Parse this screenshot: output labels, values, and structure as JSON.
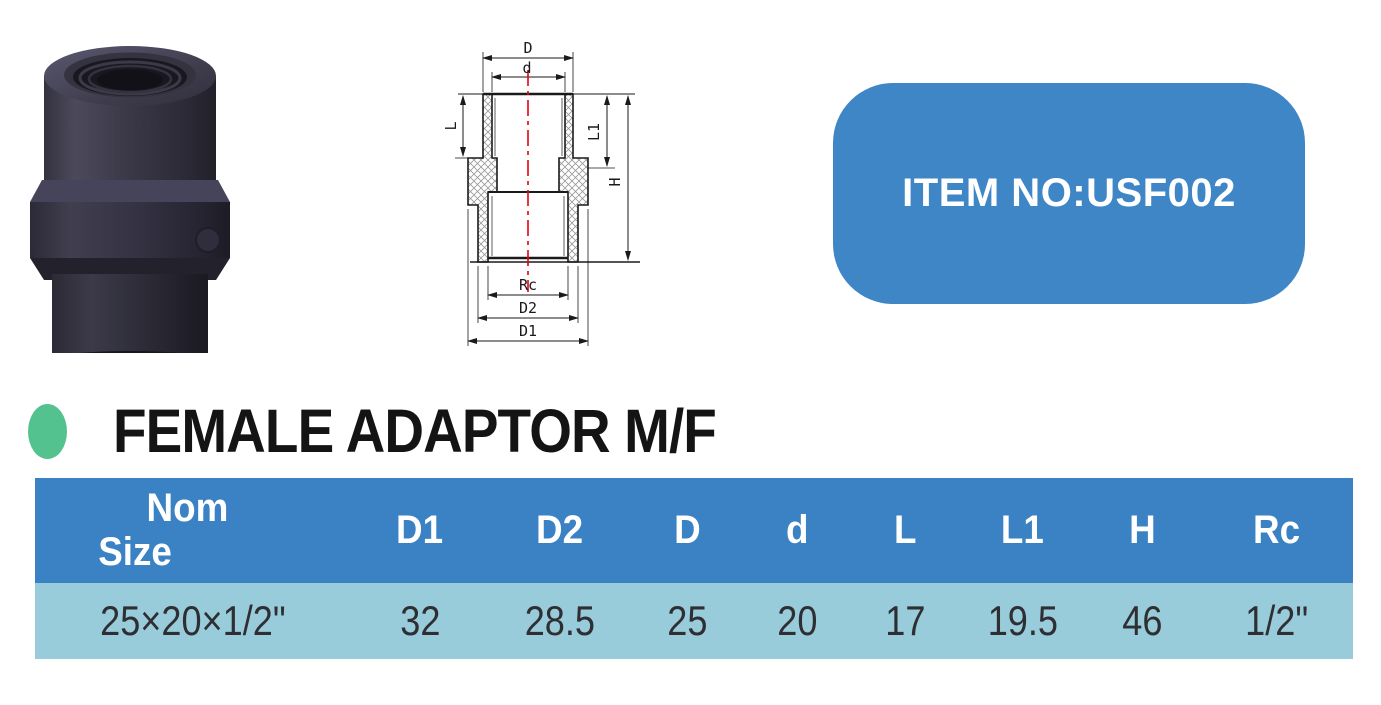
{
  "badge": {
    "item_no": "ITEM NO:USF002",
    "bg_color": "#3e86c6",
    "text_color": "#ffffff"
  },
  "product": {
    "title": "FEMALE ADAPTOR M/F",
    "bullet_color": "#54c28e",
    "photo_description": "dark PVC female adaptor fitting with hex nut"
  },
  "drawing": {
    "labels": {
      "D": "D",
      "d": "d",
      "L": "L",
      "L1": "L1",
      "H": "H",
      "Rc": "Rc",
      "D2": "D2",
      "D1": "D1"
    },
    "centerline_color": "#e60012",
    "hatch_color": "#999999"
  },
  "table": {
    "header_bg": "#3a82c3",
    "row_bg": "#98ccda",
    "header_nom": {
      "line1": "Nom",
      "line2": "Size"
    },
    "headers": [
      "D1",
      "D2",
      "D",
      "d",
      "L",
      "L1",
      "H",
      "Rc"
    ],
    "rows": [
      [
        "25×20×1/2\"",
        "32",
        "28.5",
        "25",
        "20",
        "17",
        "19.5",
        "46",
        "1/2\""
      ]
    ]
  }
}
